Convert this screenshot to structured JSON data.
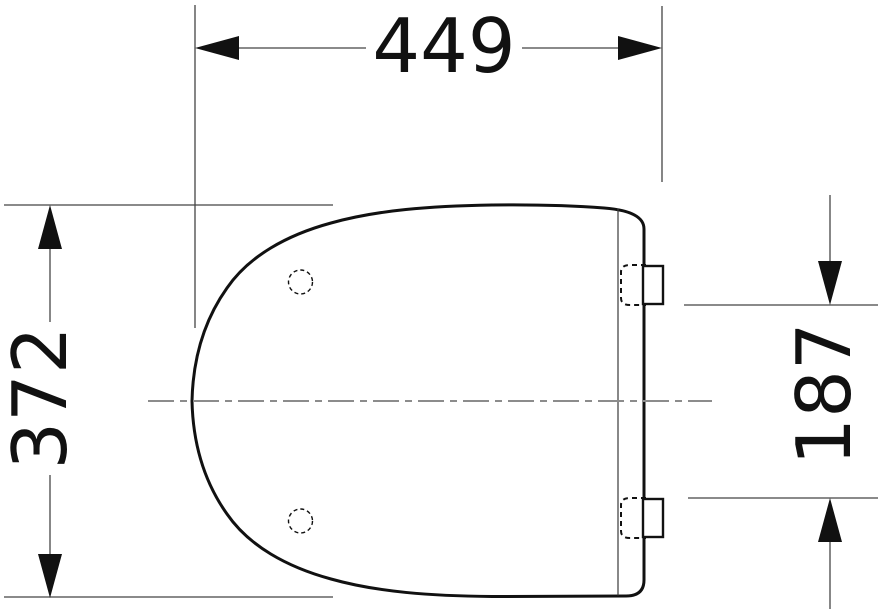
{
  "drawing": {
    "subject": "toilet-seat-lid-top-view",
    "dimensions": {
      "width": "449",
      "depth": "372",
      "hinge_spacing": "187"
    },
    "colors": {
      "outline": "#111111",
      "extension_line": "#444444",
      "dimension_line": "#7a7a7a",
      "centerline": "#8c8c8c",
      "arrow": "#111111",
      "text": "#111111",
      "background": "#ffffff"
    }
  }
}
